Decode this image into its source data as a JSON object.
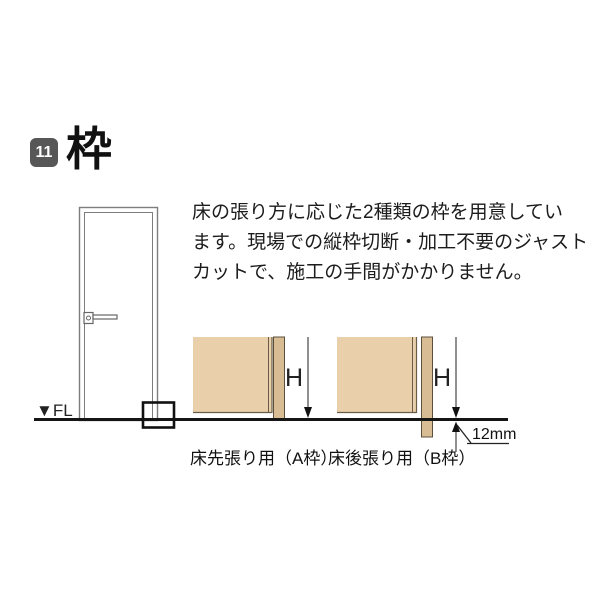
{
  "page": {
    "header": {
      "section_number": "11",
      "title": "枠",
      "badge_color": "#575757"
    },
    "description": {
      "lines": [
        "床の張り方に応じた2種類の枠を用意してい",
        "ます。現場での縦枠切断・加工不要のジャスト",
        "カットで、施工の手間がかかりません。"
      ]
    },
    "illustration": {
      "floor_label": "▼FL",
      "diagrams": [
        {
          "id": "A",
          "caption": "床先張り用（A枠）",
          "height_label": "H"
        },
        {
          "id": "B",
          "caption": "床後張り用（B枠）",
          "height_label": "H",
          "below_floor_dimension": "12mm"
        }
      ],
      "colors": {
        "wall_fill": "#e9d0ab",
        "frame_fill": "#d8bd94",
        "wall_edge_line": "#6a5c48",
        "floor_line": "#151515",
        "door_line": "#7d7d7d"
      }
    }
  }
}
